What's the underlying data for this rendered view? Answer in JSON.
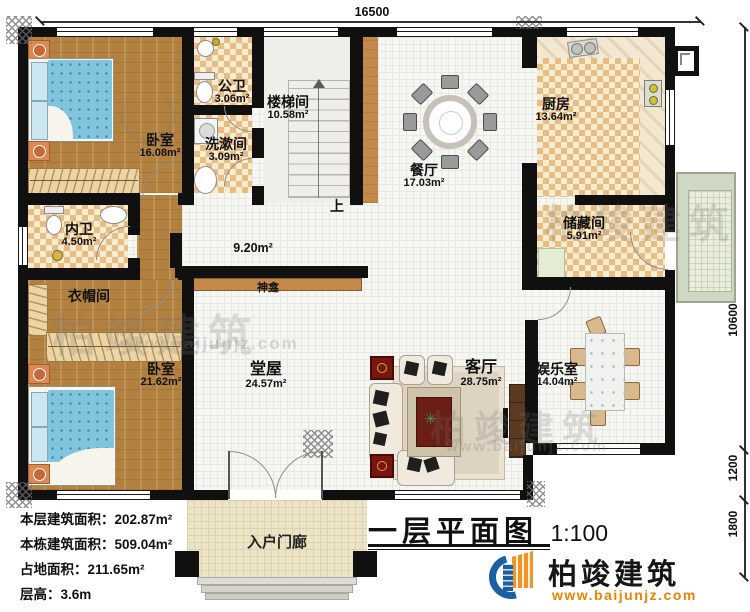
{
  "title": {
    "text": "一层平面图",
    "scale": "1:100"
  },
  "dimensions": {
    "top": "16500",
    "right_upper": "10600",
    "right_mid": "1200",
    "right_lower": "1800"
  },
  "rooms": [
    {
      "name": "卧室",
      "area": "16.08m²"
    },
    {
      "name": "公卫",
      "area": "3.06m²"
    },
    {
      "name": "楼梯间",
      "area": "10.58m²"
    },
    {
      "name": "洗漱间",
      "area": "3.09m²"
    },
    {
      "name": "餐厅",
      "area": "17.03m²"
    },
    {
      "name": "厨房",
      "area": "13.64m²"
    },
    {
      "name": "储藏间",
      "area": "5.91m²"
    },
    {
      "name": "内卫",
      "area": "4.50m²"
    },
    {
      "name": "衣帽间",
      "area": ""
    },
    {
      "name": "卧室",
      "area": "21.62m²"
    },
    {
      "name": "堂屋",
      "area": "24.57m²"
    },
    {
      "name": "客厅",
      "area": "28.75m²"
    },
    {
      "name": "娱乐室",
      "area": "14.04m²"
    }
  ],
  "labels": {
    "up": "上",
    "shrine": "神龛",
    "hall_area": "9.20m²",
    "porch": "入户门廊"
  },
  "info": [
    "本层建筑面积：202.87m²",
    "本栋建筑面积：509.04m²",
    "占地面积：211.65m²",
    "层高：3.6m"
  ],
  "brand": {
    "name": "柏竣建筑",
    "url": "www.baijunjz.com",
    "blue": "#1b5ea6",
    "orange": "#f39323"
  }
}
